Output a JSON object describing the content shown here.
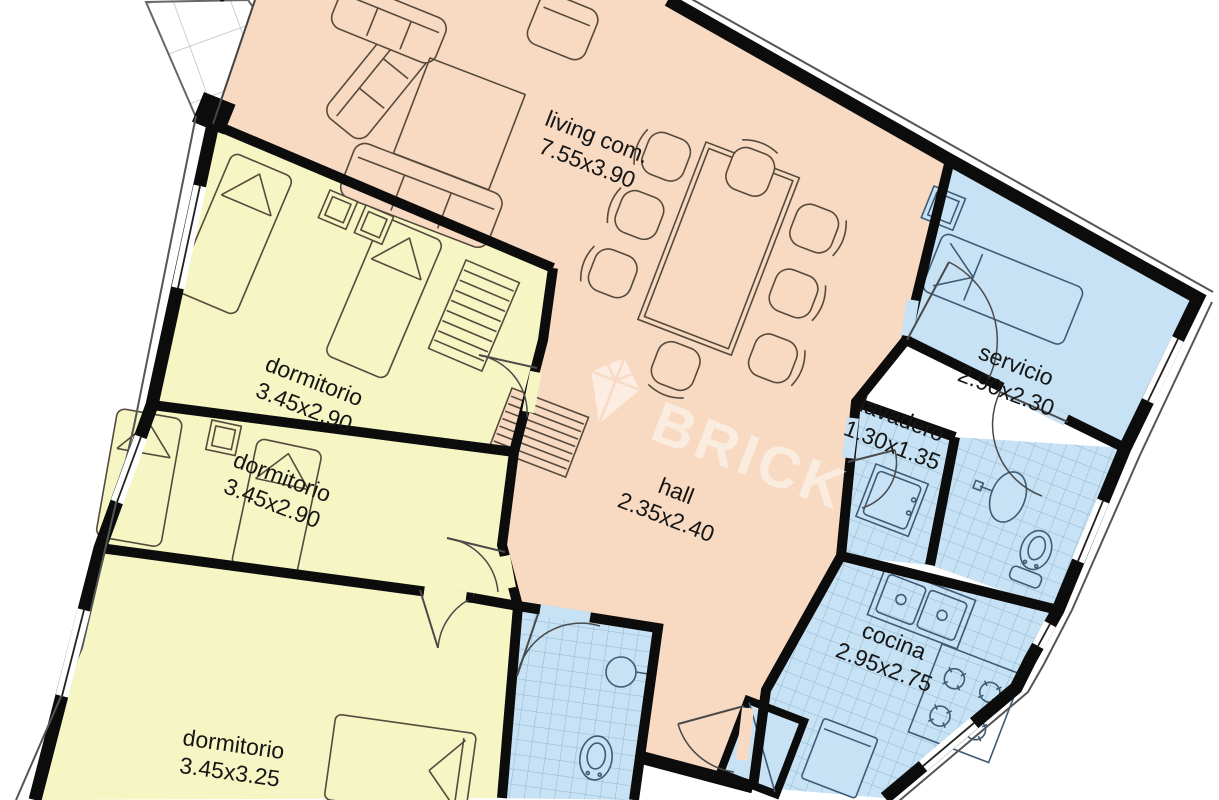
{
  "plan": {
    "watermark": {
      "text": "BRICK"
    },
    "partial_glyph": "j",
    "rooms": [
      {
        "id": "living",
        "name": "living com.",
        "dims": "7.55x3.90"
      },
      {
        "id": "dormitorio-1",
        "name": "dormitorio",
        "dims": "3.45x2.90"
      },
      {
        "id": "dormitorio-2",
        "name": "dormitorio",
        "dims": "3.45x2.90"
      },
      {
        "id": "dormitorio-3",
        "name": "dormitorio",
        "dims": "3.45x3.25"
      },
      {
        "id": "hall",
        "name": "hall",
        "dims": "2.35x2.40"
      },
      {
        "id": "servicio",
        "name": "servicio",
        "dims": "2.90x2.30"
      },
      {
        "id": "lavadero",
        "name": "lavadero",
        "dims": "1.30x1.35"
      },
      {
        "id": "cocina",
        "name": "cocina",
        "dims": "2.95x2.75"
      }
    ],
    "colors": {
      "living_hall": "#f8d9c2",
      "bedrooms": "#f6f5c4",
      "wet_rooms": "#c7e2f4",
      "walls": "#0c0c0c",
      "tile_lines": "#8fb6d0",
      "watermark": "#ffffff"
    }
  }
}
